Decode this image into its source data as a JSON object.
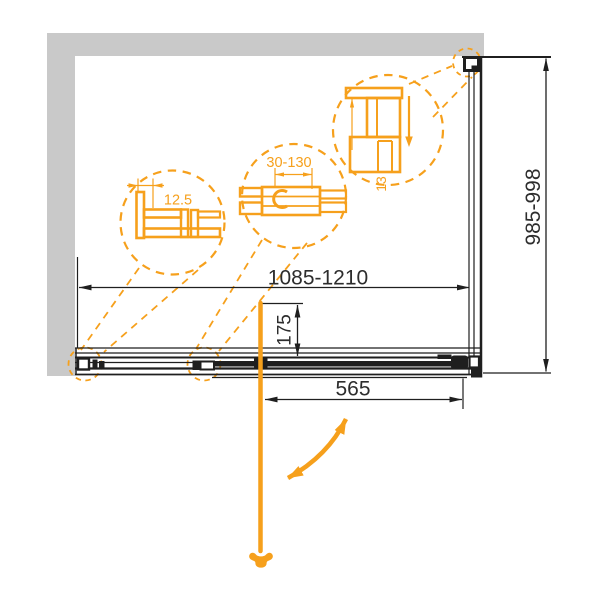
{
  "drawing": {
    "dimensions": {
      "width_range": "1085-1210",
      "height_range": "985-998",
      "door_width": "565",
      "handle_offset": "175"
    },
    "details": {
      "wall_profile": "12.5",
      "adjustment_range": "30-130",
      "top_profile": "13"
    },
    "colors": {
      "accent_orange": "#F6A01C",
      "wall_gray": "#C9C9C9",
      "line_color": "#1F1F1F",
      "text_color": "#2D2D2D"
    }
  }
}
